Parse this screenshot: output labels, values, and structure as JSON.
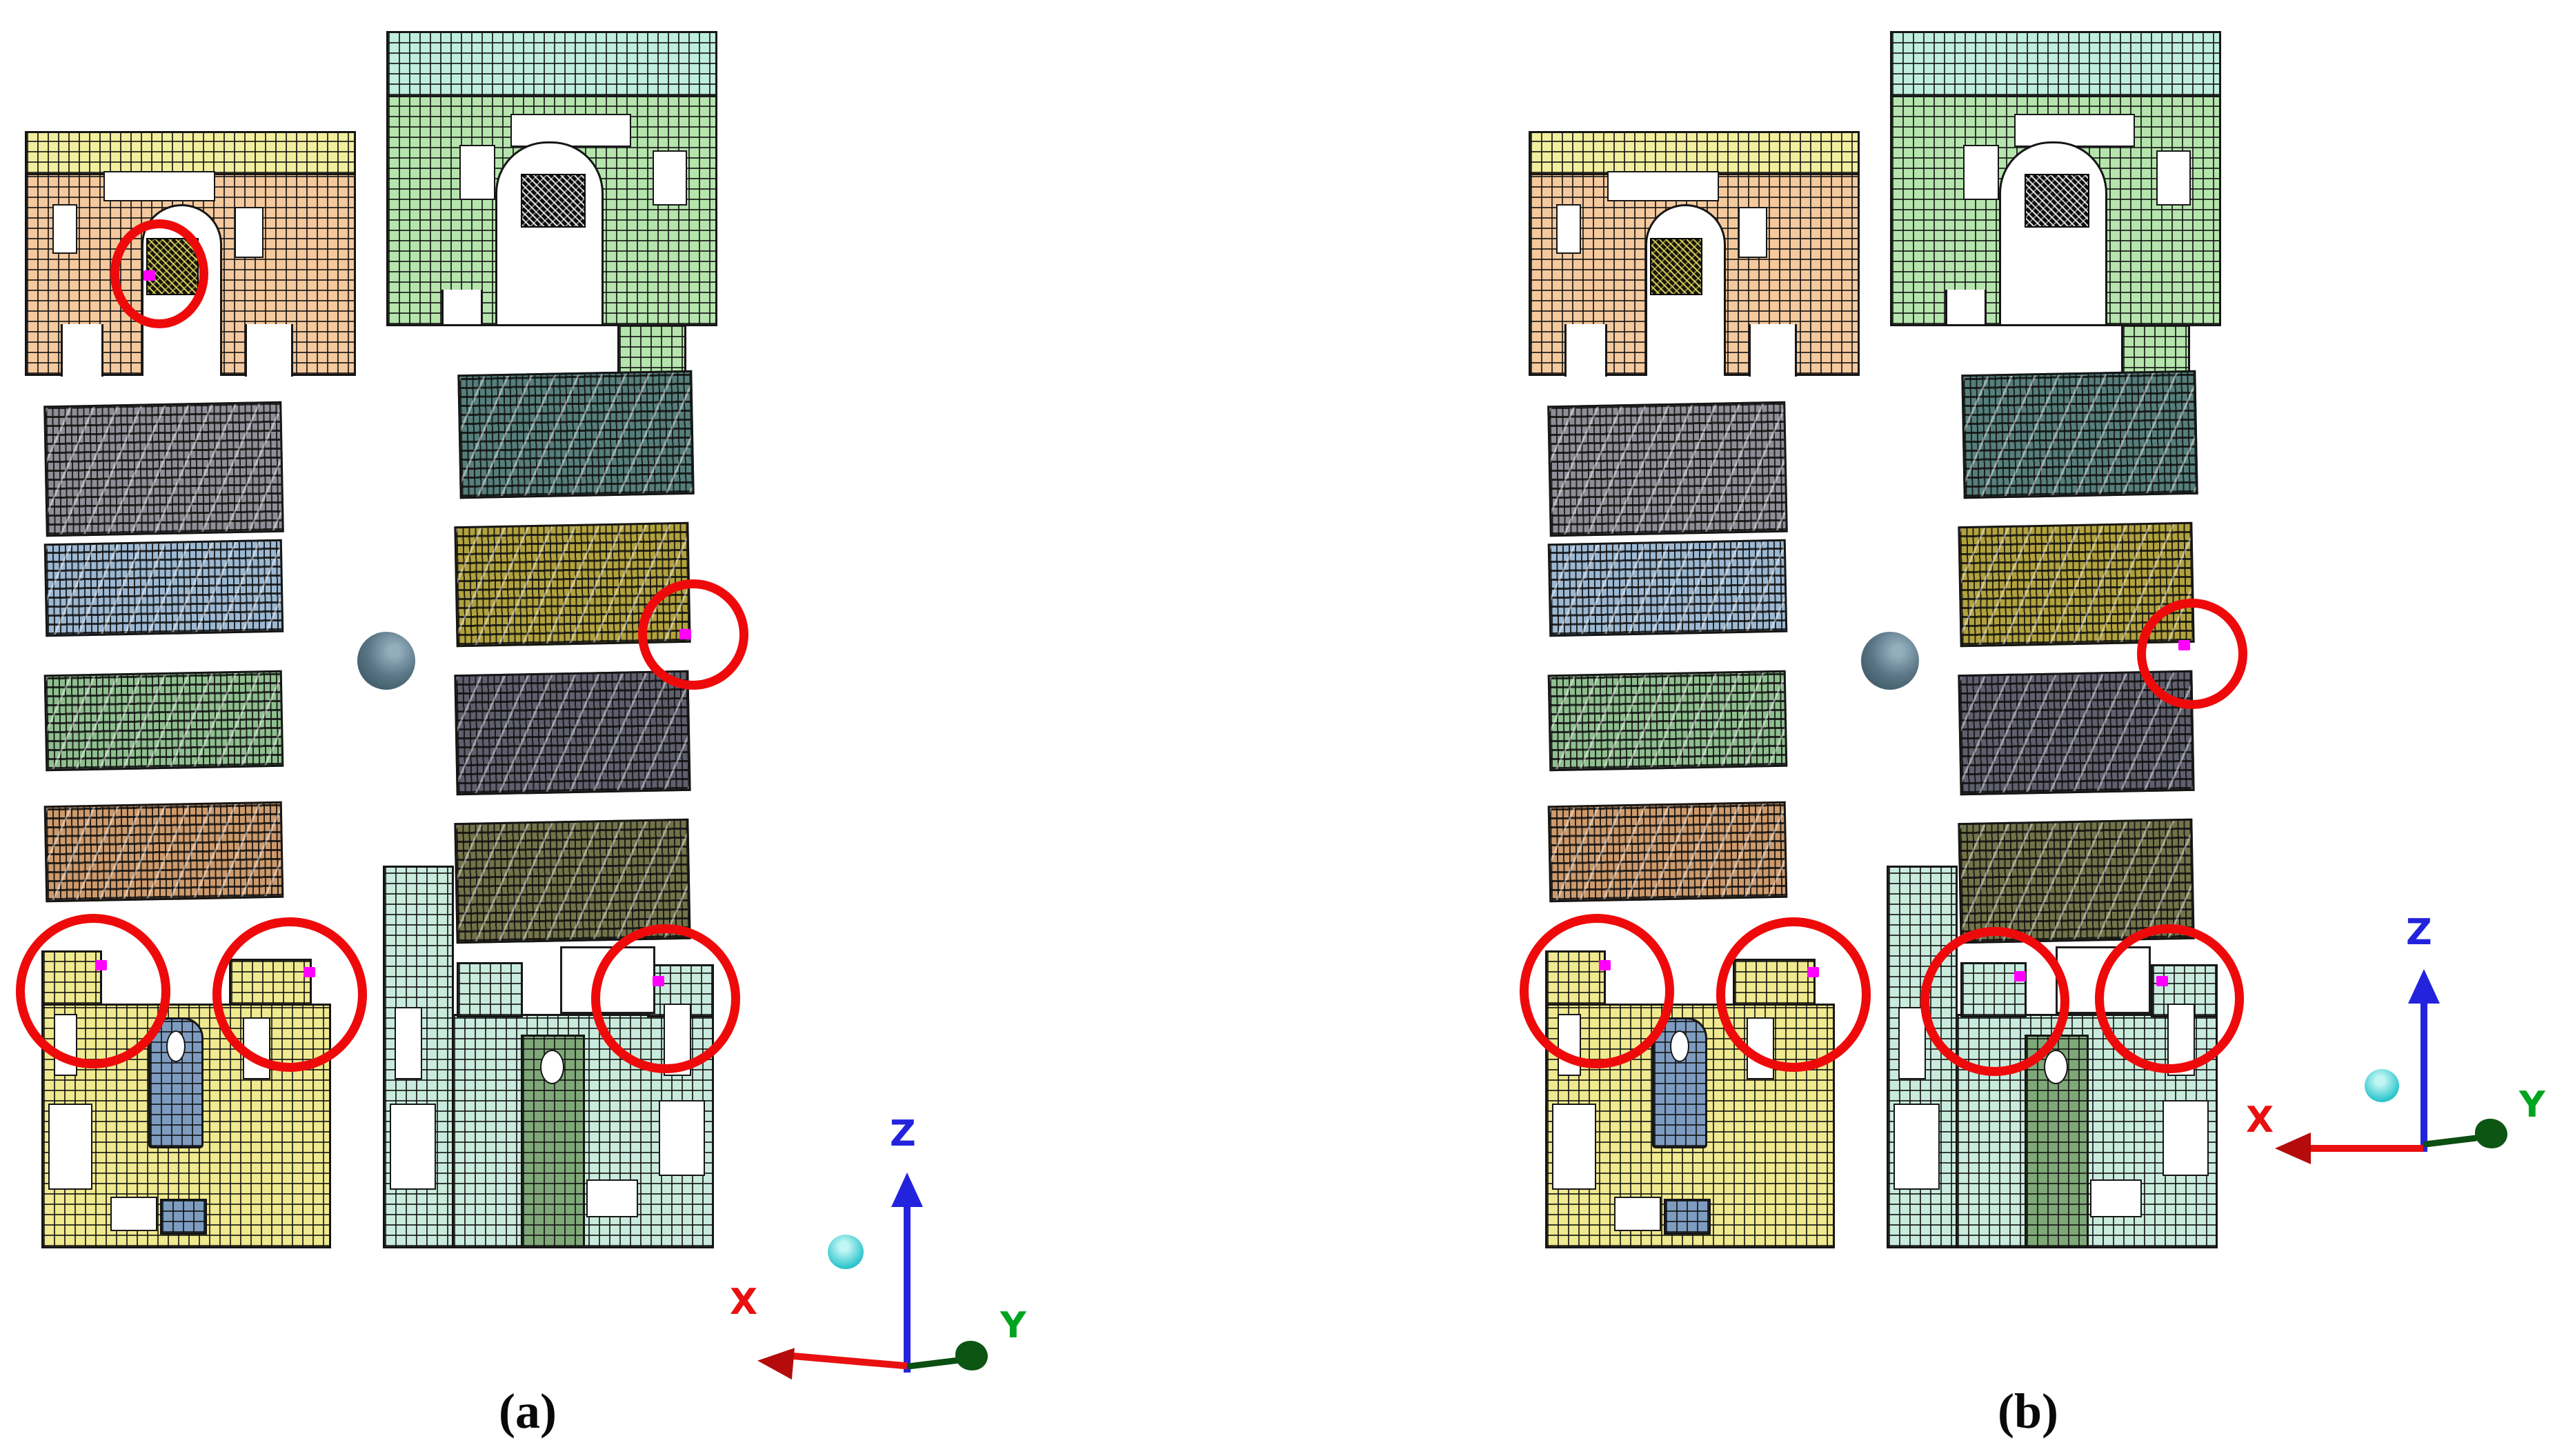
{
  "figure": {
    "panels": [
      {
        "id": "a",
        "label": "(a)",
        "highlight_circle_count": 5
      },
      {
        "id": "b",
        "label": "(b)",
        "highlight_circle_count": 5
      }
    ],
    "axis": {
      "x": "X",
      "y": "Y",
      "z": "Z"
    },
    "colors": {
      "highlight_red": "#ee0a0a",
      "marker_magenta": "#ff00ff",
      "axis_x_red": "#e81010",
      "axis_y_green": "#00a41e",
      "axis_z_blue": "#2323dd",
      "sphere_slate": "#5b7787",
      "cyan_node": "#2ec6cc",
      "plate1_band_yellow": "#f1ef9e",
      "plate1_body_peach": "#f4c99e",
      "plate2_band_mint": "#bfeede",
      "plate2_body_green": "#b5e5ad",
      "strip_gray": "#8e8e96",
      "strip_blue": "#9cb8d2",
      "strip_green": "#8fbe8f",
      "strip_orange": "#cd9a6c",
      "strip_teal_dark": "#567f7c",
      "strip_olive": "#b2a23d",
      "strip_lavender": "#5f5f6e",
      "strip_dark_olive": "#73734a",
      "plate3_yellow": "#efe98f",
      "plate3_inset_blue": "#7e9cc0",
      "plate4_teal": "#c9ebdd",
      "plate4_bar_green": "#7fa878",
      "mesh_line": "#151515"
    }
  }
}
